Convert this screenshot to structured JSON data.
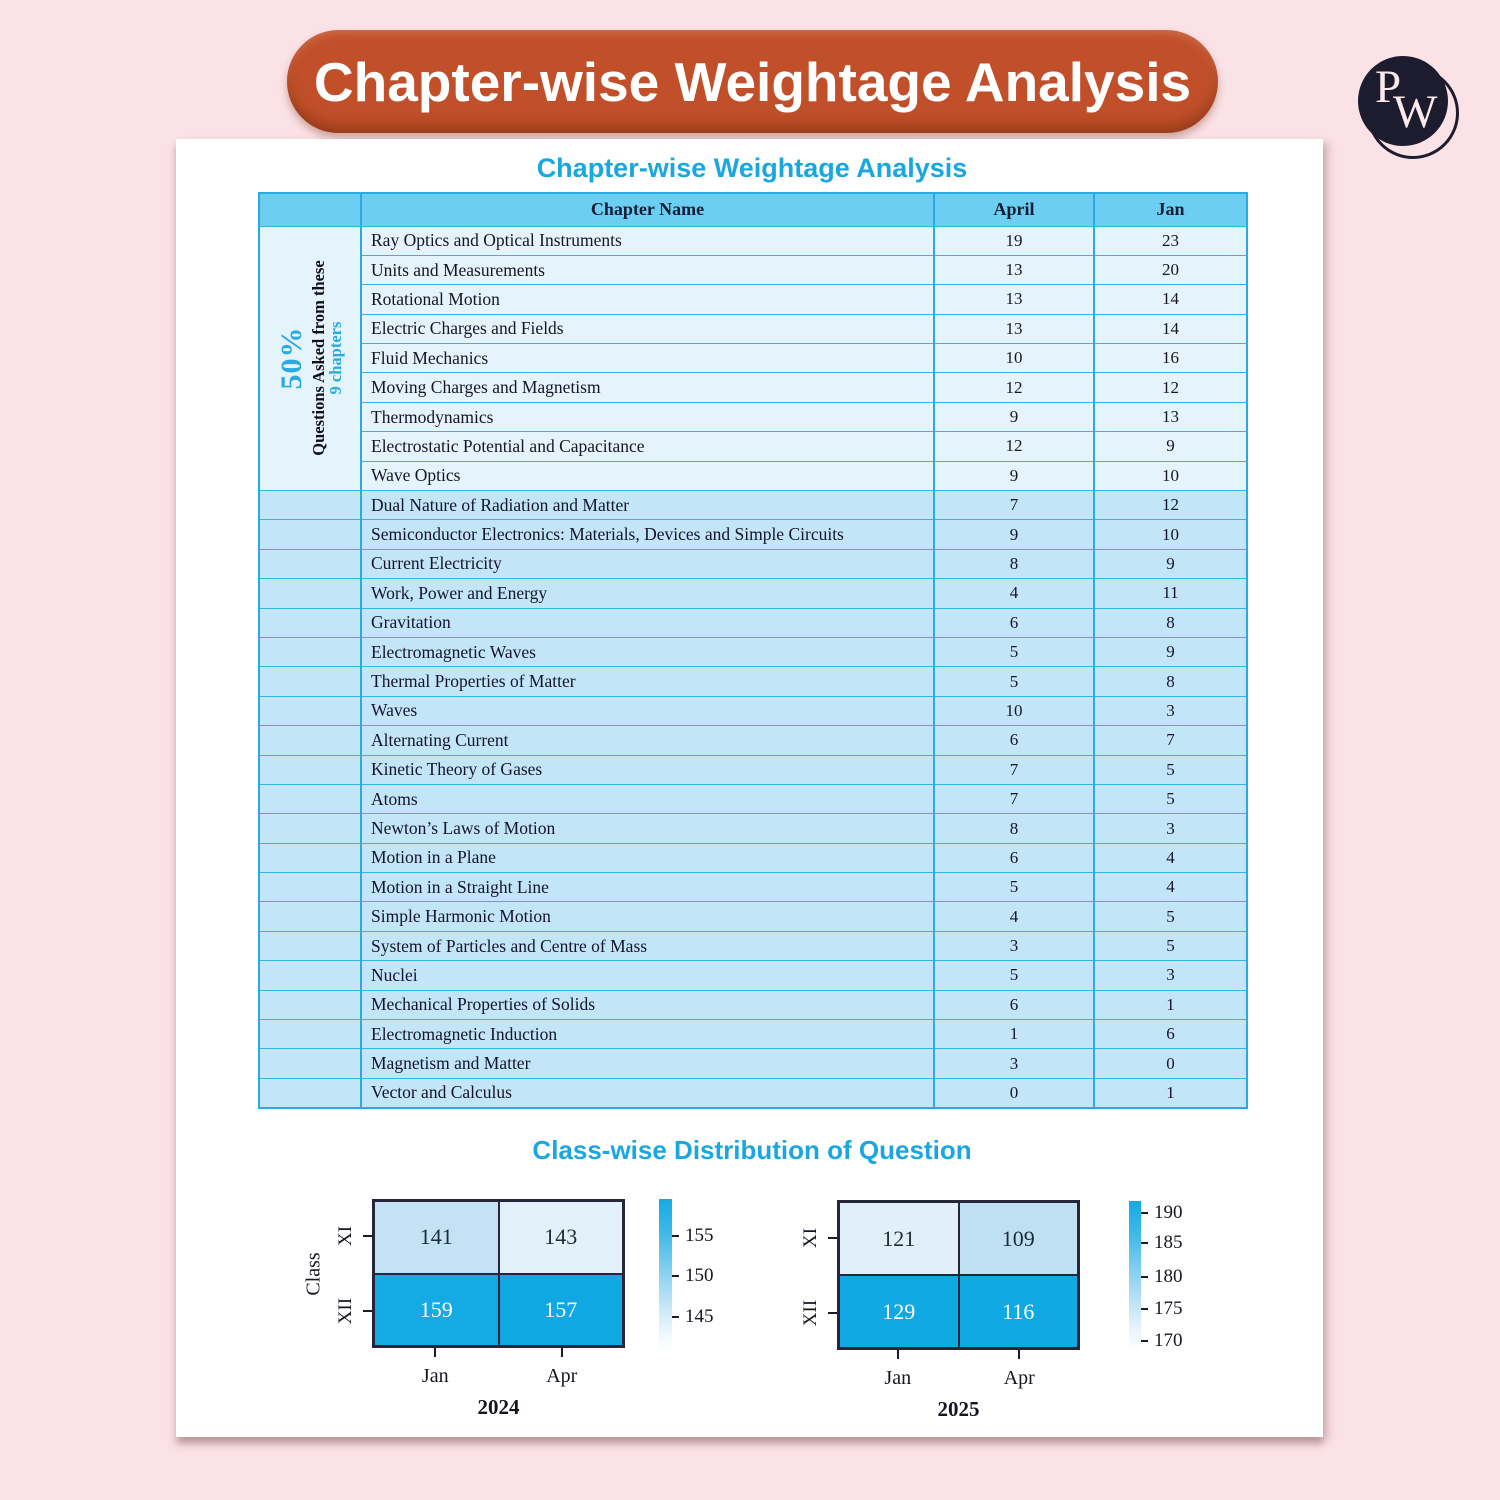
{
  "banner": {
    "title": "Chapter-wise Weightage Analysis"
  },
  "logo": {
    "letter_p": "P",
    "letter_w": "W"
  },
  "colors": {
    "accent_cyan": "#29ABE2",
    "banner_rust": "#C1502A",
    "table_header_bg": "#6CCFF1",
    "row_light_bg": "#E5F3FB",
    "row_mid_bg": "#C2E5F7",
    "page_pink": "#FBE2E6"
  },
  "card": {
    "table_title": "Chapter-wise Weightage Analysis",
    "charts_title": "Class-wise Distribution of Question"
  },
  "table": {
    "headers": {
      "chapter": "Chapter Name",
      "april": "April",
      "jan": "Jan"
    },
    "group_label": {
      "rowspan": 9,
      "percent": "50%",
      "line1": "Questions Asked from these",
      "line2": "9 chapters"
    },
    "rows": [
      {
        "chapter": "Ray Optics and Optical Instruments",
        "april": 19,
        "jan": 23
      },
      {
        "chapter": "Units and Measurements",
        "april": 13,
        "jan": 20
      },
      {
        "chapter": "Rotational Motion",
        "april": 13,
        "jan": 14
      },
      {
        "chapter": "Electric Charges and Fields",
        "april": 13,
        "jan": 14
      },
      {
        "chapter": "Fluid Mechanics",
        "april": 10,
        "jan": 16
      },
      {
        "chapter": "Moving Charges and Magnetism",
        "april": 12,
        "jan": 12
      },
      {
        "chapter": "Thermodynamics",
        "april": 9,
        "jan": 13
      },
      {
        "chapter": "Electrostatic Potential and Capacitance",
        "april": 12,
        "jan": 9
      },
      {
        "chapter": "Wave Optics",
        "april": 9,
        "jan": 10
      },
      {
        "chapter": "Dual Nature of Radiation and Matter",
        "april": 7,
        "jan": 12
      },
      {
        "chapter": "Semiconductor Electronics: Materials, Devices and Simple Circuits",
        "april": 9,
        "jan": 10
      },
      {
        "chapter": "Current Electricity",
        "april": 8,
        "jan": 9
      },
      {
        "chapter": "Work, Power and Energy",
        "april": 4,
        "jan": 11
      },
      {
        "chapter": "Gravitation",
        "april": 6,
        "jan": 8
      },
      {
        "chapter": "Electromagnetic Waves",
        "april": 5,
        "jan": 9
      },
      {
        "chapter": "Thermal Properties of Matter",
        "april": 5,
        "jan": 8
      },
      {
        "chapter": "Waves",
        "april": 10,
        "jan": 3
      },
      {
        "chapter": "Alternating Current",
        "april": 6,
        "jan": 7
      },
      {
        "chapter": "Kinetic Theory of Gases",
        "april": 7,
        "jan": 5
      },
      {
        "chapter": "Atoms",
        "april": 7,
        "jan": 5
      },
      {
        "chapter": "Newton’s Laws of Motion",
        "april": 8,
        "jan": 3
      },
      {
        "chapter": "Motion in a Plane",
        "april": 6,
        "jan": 4
      },
      {
        "chapter": "Motion in a Straight Line",
        "april": 5,
        "jan": 4
      },
      {
        "chapter": "Simple Harmonic Motion",
        "april": 4,
        "jan": 5
      },
      {
        "chapter": "System of Particles and Centre of Mass",
        "april": 3,
        "jan": 5
      },
      {
        "chapter": "Nuclei",
        "april": 5,
        "jan": 3
      },
      {
        "chapter": "Mechanical Properties of Solids",
        "april": 6,
        "jan": 1
      },
      {
        "chapter": "Electromagnetic Induction",
        "april": 1,
        "jan": 6
      },
      {
        "chapter": "Magnetism and Matter",
        "april": 3,
        "jan": 0
      },
      {
        "chapter": "Vector and Calculus",
        "april": 0,
        "jan": 1
      }
    ]
  },
  "chart_data": [
    {
      "type": "heatmap",
      "xlabel": "2024",
      "ylabel": "Class",
      "x": [
        "Jan",
        "Apr"
      ],
      "y": [
        "XI",
        "XII"
      ],
      "values": [
        [
          141,
          143
        ],
        [
          159,
          157
        ]
      ],
      "cell_colors": [
        [
          "#C3E2F4",
          "#E2F1FA"
        ],
        [
          "#14ABE5",
          "#0FA8E2"
        ]
      ],
      "text_colors": [
        [
          "#1C2B3A",
          "#1C2B3A"
        ],
        [
          "#FFFFFF",
          "#FFFFFF"
        ]
      ],
      "colorbar": {
        "ticks": [
          155,
          150,
          145
        ],
        "tick_positions_pct": [
          24,
          50,
          77
        ]
      }
    },
    {
      "type": "heatmap",
      "xlabel": "2025",
      "ylabel": "",
      "x": [
        "Jan",
        "Apr"
      ],
      "y": [
        "XI",
        "XII"
      ],
      "values": [
        [
          121,
          109
        ],
        [
          129,
          116
        ]
      ],
      "cell_colors": [
        [
          "#E0EFF9",
          "#BFE0F3"
        ],
        [
          "#10A9E3",
          "#10A9E3"
        ]
      ],
      "text_colors": [
        [
          "#1C2B3A",
          "#1C2B3A"
        ],
        [
          "#FFFFFF",
          "#FFFFFF"
        ]
      ],
      "colorbar": {
        "ticks": [
          190,
          185,
          180,
          175,
          170
        ],
        "tick_positions_pct": [
          8,
          27.5,
          50,
          71.5,
          93
        ]
      }
    }
  ]
}
